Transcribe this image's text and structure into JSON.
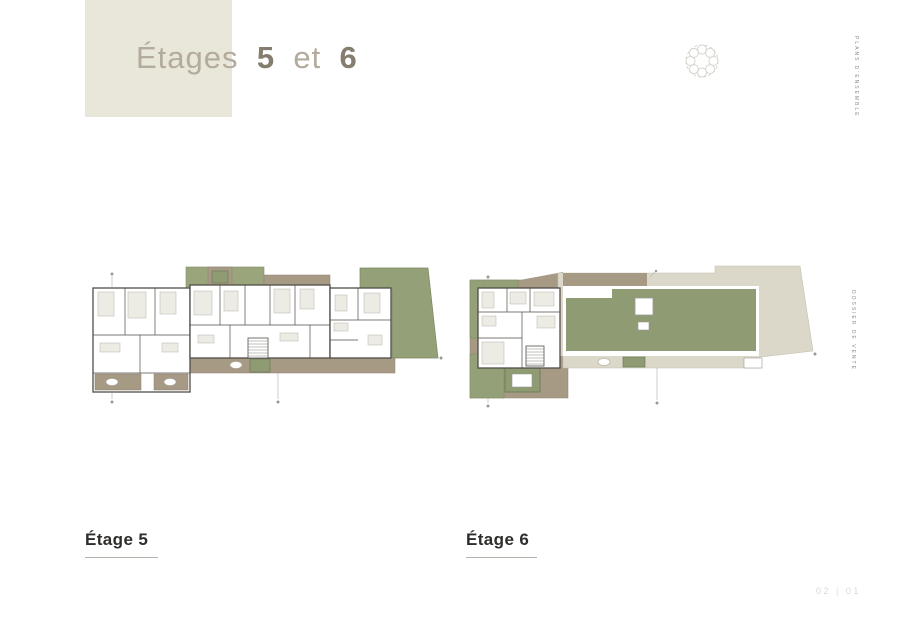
{
  "document": {
    "title": {
      "word": "Étages",
      "number_1": "5",
      "connector": "et",
      "number_2": "6"
    },
    "side_labels": {
      "top": "PLANS D'ENSEMBLE",
      "middle": "DOSSIER DE VENTE"
    },
    "plans": [
      {
        "label": "Étage 5"
      },
      {
        "label": "Étage 6"
      }
    ],
    "page_marker": "02 | 01",
    "icons": {
      "ornament": "wreath-tree-ornament-icon"
    },
    "colors": {
      "title_block_bg": "#e9e6da",
      "title_light": "#b3ab9c",
      "title_bold": "#857d6d",
      "label_text": "#2e2d2b",
      "underline": "#b6b2aa",
      "terrace_green": "#94a077",
      "planter_green": "#8f9b73",
      "deck_brown": "#a79a85",
      "roof_beige": "#dbd8ca",
      "wall_line": "#514e48"
    }
  }
}
